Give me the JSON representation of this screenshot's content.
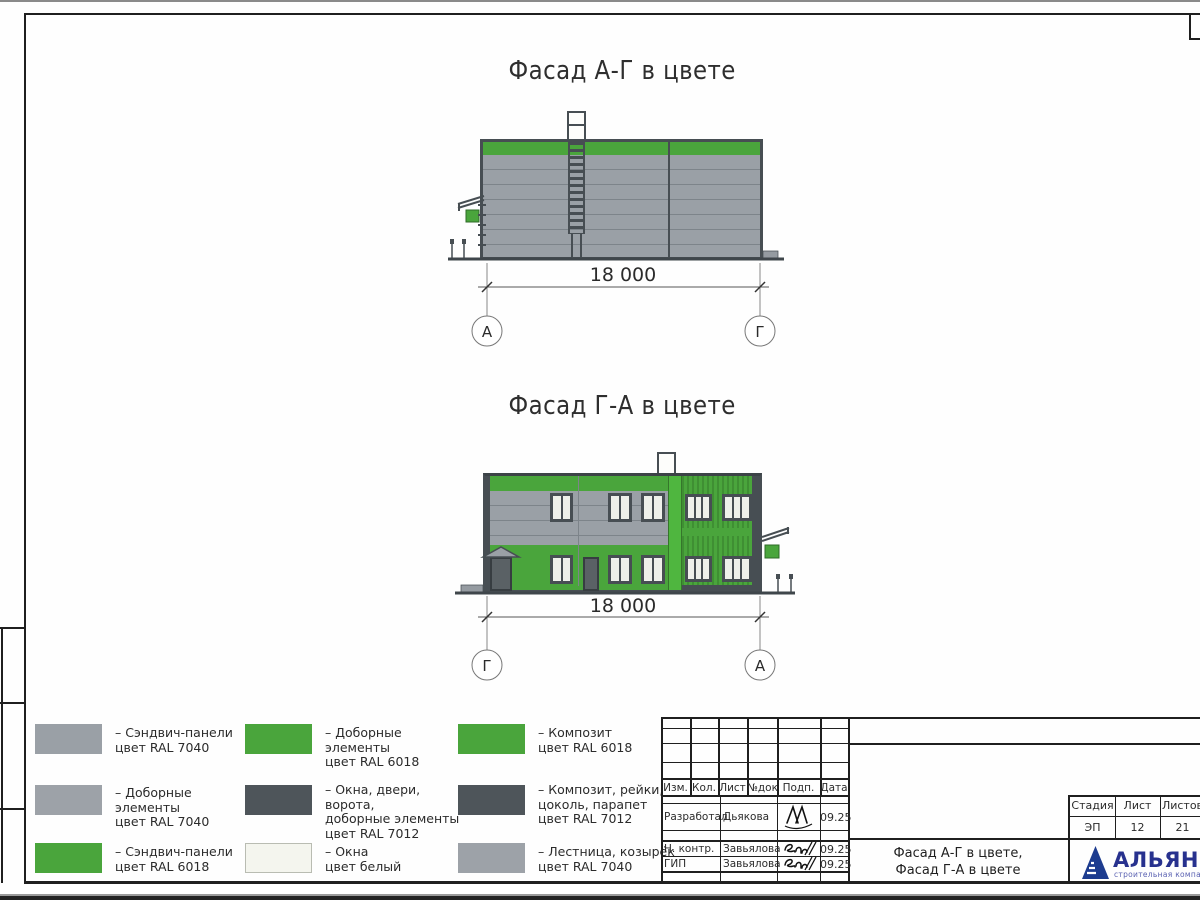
{
  "sheet": {
    "facade1": {
      "title": "Фасад А-Г в цвете",
      "dimension": "18 000",
      "axis_left": "А",
      "axis_right": "Г"
    },
    "facade2": {
      "title": "Фасад Г-А в цвете",
      "dimension": "18 000",
      "axis_left": "Г",
      "axis_right": "А"
    }
  },
  "legend": {
    "items": [
      {
        "swatch": "#9aa0a6",
        "lines": [
          "– Сэндвич-панели",
          "цвет RAL 7040"
        ]
      },
      {
        "swatch": "#9da2a8",
        "lines": [
          "– Доборные элементы",
          "цвет RAL 7040"
        ]
      },
      {
        "swatch": "#4aa53c",
        "lines": [
          "– Сэндвич-панели",
          "цвет RAL 6018"
        ]
      },
      {
        "swatch": "#4aa53c",
        "lines": [
          "– Доборные элементы",
          "цвет RAL 6018"
        ]
      },
      {
        "swatch": "#4e555a",
        "lines": [
          "– Окна, двери, ворота,",
          "доборные элементы",
          "цвет RAL 7012"
        ]
      },
      {
        "swatch": "#f4f5ee",
        "lines": [
          "– Окна",
          "цвет белый"
        ]
      },
      {
        "swatch": "#4aa53c",
        "lines": [
          "– Композит",
          "цвет RAL 6018"
        ]
      },
      {
        "swatch": "#4e555a",
        "lines": [
          "– Композит, рейки,",
          "цоколь, парапет",
          "цвет RAL 7012"
        ]
      },
      {
        "swatch": "#9da2a8",
        "lines": [
          "– Лестница, козырёк",
          "цвет RAL 7040"
        ]
      }
    ]
  },
  "titleblock": {
    "cols": [
      "Изм.",
      "Кол.",
      "Лист",
      "№док",
      "Подп.",
      "Дата"
    ],
    "rows": [
      {
        "role": "Разработал",
        "name": "Дьякова",
        "date": "09.25"
      },
      {
        "role": "Н. контр.",
        "name": "Завьялова",
        "date": "09.25"
      },
      {
        "role": "ГИП",
        "name": "Завьялова",
        "date": "09.25"
      }
    ],
    "stage": {
      "label": "Стадия",
      "value": "ЭП"
    },
    "sheet_no": {
      "label": "Лист",
      "value": "12"
    },
    "sheets_total": {
      "label": "Листов",
      "value": "21"
    },
    "doc_title": [
      "Фасад А-Г в цвете,",
      "Фасад Г-А в цвете"
    ],
    "company": {
      "name": "АЛЬЯНС",
      "subtitle": "строительная компания"
    }
  },
  "colors": {
    "green_ral6018": "#4aa53c",
    "gray_ral7040": "#9aa0a6",
    "dark_ral7012": "#4e555a",
    "window_white": "#f0f2ec",
    "logo_blue": "#1d3c8f"
  }
}
